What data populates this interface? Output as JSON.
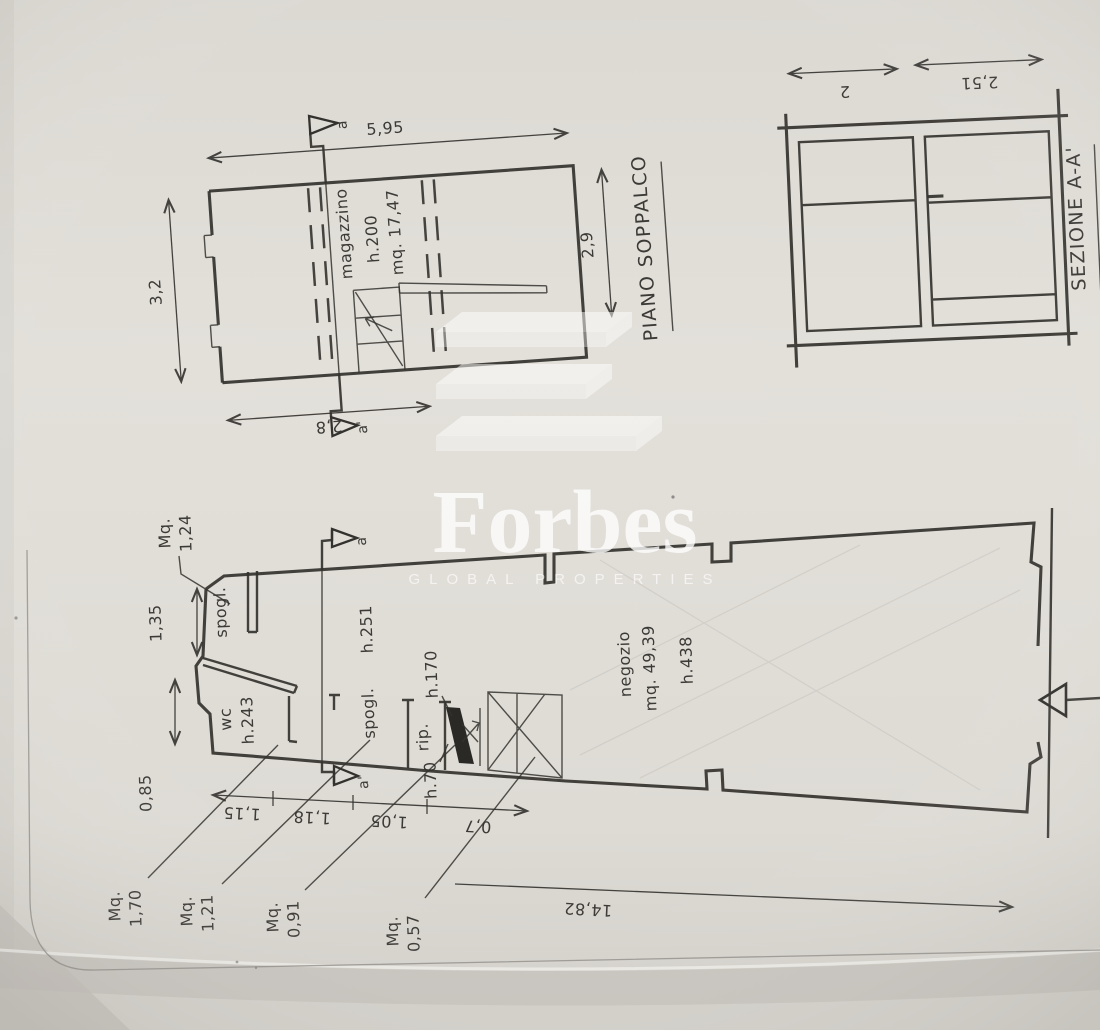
{
  "palette": {
    "paper": "#e0ddd7",
    "paper-dark": "#cfccc6",
    "line": "#34322e",
    "wm": "#ffffff"
  },
  "watermark": {
    "brand": "Forbes",
    "tagline": "GLOBAL PROPERTIES"
  },
  "soppalco_plan": {
    "title": "PIANO SOPPALCO",
    "room": {
      "name": "magazzino",
      "height": "h.200",
      "area": "mq. 17,47"
    },
    "dims": {
      "top": "5,95",
      "left": "3,2",
      "right": "2,9",
      "bottom": "2,8"
    },
    "section_markers": {
      "top": "a",
      "bottom": "a'"
    }
  },
  "section_view": {
    "title": "SEZIONE A-A'",
    "dims": {
      "left": "2",
      "right": "2,51"
    }
  },
  "ground_plan": {
    "rooms": {
      "spogl_upper": "spogl.",
      "wc": {
        "name": "wc",
        "height": "h.243"
      },
      "spogl_lower": "spogl.",
      "rip": {
        "name": "rip.",
        "height": "h.70"
      },
      "negozio": {
        "name": "negozio",
        "area": "mq. 49,39",
        "height": "h.438"
      },
      "open_area_height": "h.251",
      "passage_height": "h.170"
    },
    "area_labels": [
      {
        "prefix": "Mq.",
        "value": "1,24"
      },
      {
        "prefix": "Mq.",
        "value": "1,70"
      },
      {
        "prefix": "Mq.",
        "value": "1,21"
      },
      {
        "prefix": "Mq.",
        "value": "0,91"
      },
      {
        "prefix": "Mq.",
        "value": "0,57"
      }
    ],
    "dims": {
      "left_upper": "1,35",
      "left_lower": "0,85",
      "chain": [
        "1,15",
        "1,18",
        "1,05",
        "0,7"
      ],
      "total": "14,82"
    },
    "section_markers": {
      "top": "a",
      "bottom": "a'"
    }
  }
}
